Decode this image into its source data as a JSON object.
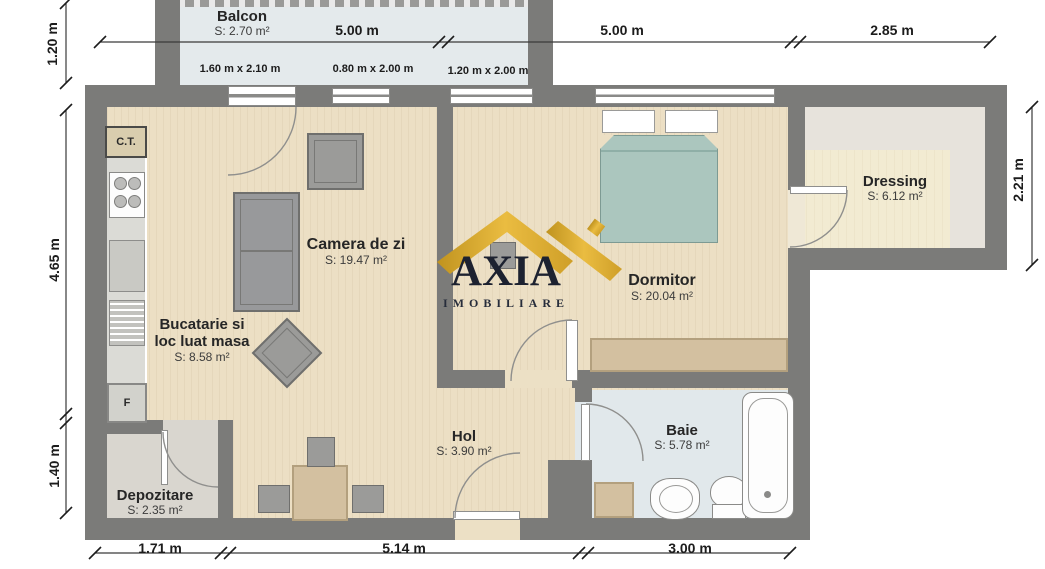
{
  "title": "Apartment floor plan",
  "watermark": {
    "brand": "AXIA",
    "subtitle": "IMOBILIARE",
    "roof_color": "#d9a62e"
  },
  "rooms": [
    {
      "id": "balcon",
      "name": "Balcon",
      "area": "S: 2.70 m²"
    },
    {
      "id": "camera_de_zi",
      "name": "Camera de zi",
      "area": "S: 19.47 m²"
    },
    {
      "id": "bucatarie",
      "name_line1": "Bucatarie si",
      "name_line2": "loc luat masa",
      "area": "S: 8.58 m²"
    },
    {
      "id": "dormitor",
      "name": "Dormitor",
      "area": "S: 20.04 m²"
    },
    {
      "id": "dressing",
      "name": "Dressing",
      "area": "S: 6.12 m²"
    },
    {
      "id": "baie",
      "name": "Baie",
      "area": "S: 5.78 m²"
    },
    {
      "id": "hol",
      "name": "Hol",
      "area": "S: 3.90 m²"
    },
    {
      "id": "depozitare",
      "name": "Depozitare",
      "area": "S: 2.35 m²"
    }
  ],
  "labels": {
    "ct": "C.T.",
    "f": "F"
  },
  "dimensions": {
    "top": [
      "5.00 m",
      "5.00 m",
      "2.85 m"
    ],
    "bottom": [
      "1.71 m",
      "5.14 m",
      "3.00 m"
    ],
    "left": [
      "1.20 m",
      "4.65 m",
      "1.40 m"
    ],
    "right": [
      "2.21 m"
    ],
    "windows": [
      "1.60 m x 2.10 m",
      "0.80 m x 2.00 m",
      "1.20 m x 2.00 m"
    ]
  },
  "colors": {
    "wall": "#7b7b79",
    "floor": "#ecdfc4",
    "wet_floor": "#e1e8eb",
    "storage_floor": "#d9d6cf",
    "dressing_floor": "#f2ebd2",
    "bed": "#abc6be",
    "furniture": "#9b9b99",
    "wood": "#d3c0a0",
    "gold": "#d9a62e",
    "brand_text": "#1d2230"
  }
}
